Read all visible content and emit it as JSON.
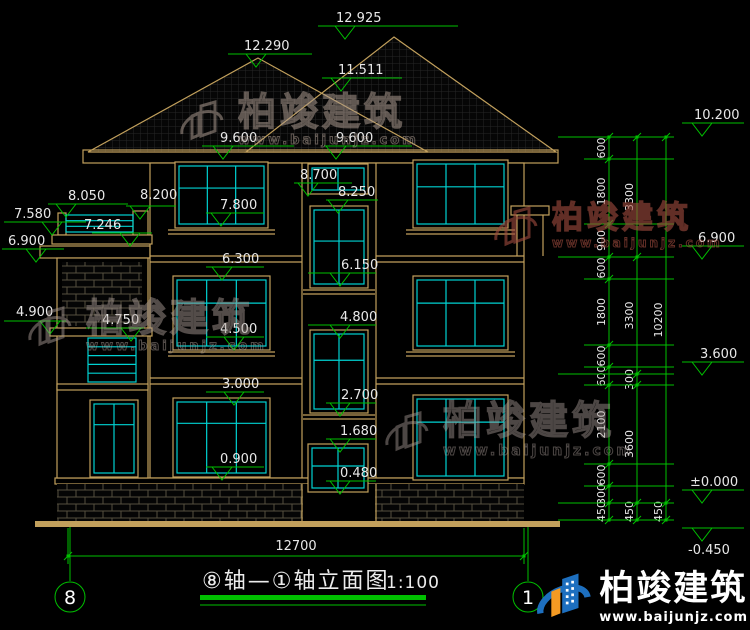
{
  "colors": {
    "green": "#00c000",
    "cyan": "#00d2d2",
    "tan": "#c2a05c",
    "text": "#e8e8e8",
    "brand_blue": "#1d6fbf",
    "brand_orange": "#f59a23"
  },
  "title": {
    "text": "⑧轴—①轴立面图",
    "scale": "1:100"
  },
  "axis_bubbles": [
    {
      "label": "8",
      "x": 70,
      "y": 597
    },
    {
      "label": "1",
      "x": 528,
      "y": 597
    }
  ],
  "bottom_dim": {
    "label": "12700",
    "y": 556,
    "x1": 68,
    "x2": 524,
    "tx": 296,
    "ty": 550
  },
  "elevation_markers": [
    {
      "t": "12.925",
      "tx": 336,
      "ty": 22,
      "y": 26,
      "x1": 318,
      "x2": 458,
      "ax": 345
    },
    {
      "t": "12.290",
      "tx": 244,
      "ty": 50,
      "y": 54,
      "x1": 228,
      "x2": 312,
      "ax": 256
    },
    {
      "t": "11.511",
      "tx": 338,
      "ty": 74,
      "y": 78,
      "x1": 322,
      "x2": 402,
      "ax": 341
    },
    {
      "t": "9.600",
      "tx": 220,
      "ty": 142,
      "y": 146,
      "x1": 202,
      "x2": 294,
      "ax": 223
    },
    {
      "t": "9.600",
      "tx": 336,
      "ty": 142,
      "y": 146,
      "x1": 324,
      "x2": 412,
      "ax": 336
    },
    {
      "t": "8.700",
      "tx": 300,
      "ty": 179,
      "y": 183,
      "x1": 294,
      "x2": 352,
      "ax": 308
    },
    {
      "t": "8.250",
      "tx": 338,
      "ty": 196,
      "y": 200,
      "x1": 326,
      "x2": 378,
      "ax": 338
    },
    {
      "t": "8.050",
      "tx": 68,
      "ty": 200,
      "y": 204,
      "x1": 48,
      "x2": 128,
      "ax": 66
    },
    {
      "t": "8.200",
      "tx": 140,
      "ty": 199,
      "y": 206,
      "x1": 126,
      "x2": 176,
      "ax": 140
    },
    {
      "t": "7.580",
      "tx": 14,
      "ty": 218,
      "y": 222,
      "x1": 4,
      "x2": 86,
      "ax": 52
    },
    {
      "t": "7.246",
      "tx": 84,
      "ty": 229,
      "y": 233,
      "x1": 92,
      "x2": 152,
      "ax": 130
    },
    {
      "t": "6.900",
      "tx": 8,
      "ty": 245,
      "y": 249,
      "x1": 2,
      "x2": 64,
      "ax": 36
    },
    {
      "t": "7.800",
      "tx": 220,
      "ty": 209,
      "y": 213,
      "x1": 206,
      "x2": 264,
      "ax": 221
    },
    {
      "t": "6.300",
      "tx": 222,
      "ty": 263,
      "y": 267,
      "x1": 206,
      "x2": 264,
      "ax": 222
    },
    {
      "t": "6.150",
      "tx": 341,
      "ty": 269,
      "y": 273,
      "x1": 308,
      "x2": 376,
      "ax": 340
    },
    {
      "t": "4.900",
      "tx": 16,
      "ty": 316,
      "y": 321,
      "x1": 4,
      "x2": 66,
      "ax": 50
    },
    {
      "t": "4.750",
      "tx": 102,
      "ty": 324,
      "y": 328,
      "x1": 86,
      "x2": 144,
      "ax": 131
    },
    {
      "t": "4.500",
      "tx": 220,
      "ty": 333,
      "y": 337,
      "x1": 206,
      "x2": 264,
      "ax": 234
    },
    {
      "t": "4.800",
      "tx": 340,
      "ty": 321,
      "y": 325,
      "x1": 308,
      "x2": 376,
      "ax": 340
    },
    {
      "t": "3.000",
      "tx": 222,
      "ty": 388,
      "y": 392,
      "x1": 206,
      "x2": 264,
      "ax": 234
    },
    {
      "t": "2.700",
      "tx": 341,
      "ty": 399,
      "y": 403,
      "x1": 326,
      "x2": 376,
      "ax": 340
    },
    {
      "t": "1.680",
      "tx": 340,
      "ty": 435,
      "y": 439,
      "x1": 326,
      "x2": 376,
      "ax": 340
    },
    {
      "t": "0.900",
      "tx": 220,
      "ty": 463,
      "y": 467,
      "x1": 206,
      "x2": 264,
      "ax": 222
    },
    {
      "t": "0.480",
      "tx": 340,
      "ty": 477,
      "y": 481,
      "x1": 326,
      "x2": 376,
      "ax": 340
    },
    {
      "t": "10.200",
      "tx": 694,
      "ty": 119,
      "y": 123,
      "x1": 682,
      "x2": 744,
      "ax": 702
    },
    {
      "t": "6.900",
      "tx": 698,
      "ty": 242,
      "y": 246,
      "x1": 682,
      "x2": 744,
      "ax": 702
    },
    {
      "t": "3.600",
      "tx": 700,
      "ty": 358,
      "y": 362,
      "x1": 682,
      "x2": 744,
      "ax": 702
    },
    {
      "t": "±0.000",
      "tx": 690,
      "ty": 486,
      "y": 490,
      "x1": 682,
      "x2": 744,
      "ax": 702
    },
    {
      "t": "-0.450",
      "tx": 688,
      "ty": 554,
      "y": 528,
      "x1": 682,
      "x2": 744,
      "ax": 702
    }
  ],
  "dim_chains": [
    {
      "x": 609,
      "ticks": [
        137,
        159,
        224,
        257,
        279,
        345,
        367,
        385,
        464,
        486,
        503,
        520
      ],
      "labels": [
        "600",
        "1800",
        "900",
        "600",
        "1800",
        "600",
        "600",
        "2100",
        "600",
        "300",
        "450"
      ]
    },
    {
      "x": 637,
      "ticks": [
        137,
        257,
        374,
        385,
        503,
        520
      ],
      "labels": [
        "3300",
        "3300",
        "300",
        "3600",
        "450"
      ]
    },
    {
      "x": 666,
      "ticks": [
        137,
        503,
        520
      ],
      "labels": [
        "10200",
        "450"
      ]
    }
  ],
  "ext_lines": [
    {
      "y": 137,
      "x1": 558
    },
    {
      "y": 159,
      "x1": 584
    },
    {
      "y": 224,
      "x1": 584
    },
    {
      "y": 257,
      "x1": 558
    },
    {
      "y": 279,
      "x1": 584
    },
    {
      "y": 345,
      "x1": 584
    },
    {
      "y": 367,
      "x1": 584
    },
    {
      "y": 374,
      "x1": 558
    },
    {
      "y": 385,
      "x1": 584
    },
    {
      "y": 464,
      "x1": 584
    },
    {
      "y": 486,
      "x1": 584
    },
    {
      "y": 503,
      "x1": 558
    },
    {
      "y": 520,
      "x1": 558
    }
  ],
  "windows": [
    {
      "x": 175,
      "y": 162,
      "w": 93,
      "h": 66,
      "c": 3,
      "s": 0.38
    },
    {
      "x": 413,
      "y": 160,
      "w": 95,
      "h": 68,
      "c": 3,
      "s": 0.38
    },
    {
      "x": 308,
      "y": 164,
      "w": 60,
      "h": 30,
      "c": 2,
      "s": 0
    },
    {
      "x": 310,
      "y": 206,
      "w": 58,
      "h": 82,
      "c": 2,
      "s": 0.42
    },
    {
      "x": 173,
      "y": 276,
      "w": 97,
      "h": 74,
      "c": 3,
      "s": 0.35
    },
    {
      "x": 413,
      "y": 276,
      "w": 95,
      "h": 74,
      "c": 3,
      "s": 0.35
    },
    {
      "x": 310,
      "y": 330,
      "w": 58,
      "h": 83,
      "c": 2,
      "s": 0.35
    },
    {
      "x": 173,
      "y": 398,
      "w": 97,
      "h": 79,
      "c": 3,
      "s": 0.3
    },
    {
      "x": 413,
      "y": 395,
      "w": 95,
      "h": 85,
      "c": 3,
      "s": 0.3
    },
    {
      "x": 308,
      "y": 444,
      "w": 60,
      "h": 48,
      "c": 2,
      "s": 0.45
    },
    {
      "x": 90,
      "y": 400,
      "w": 48,
      "h": 77,
      "c": 2,
      "s": 0.3
    }
  ],
  "railings": [
    {
      "x": 66,
      "y": 215,
      "w": 67,
      "h": 17,
      "bars": 2
    },
    {
      "x": 88,
      "y": 338,
      "w": 48,
      "h": 44,
      "bars": 4
    }
  ],
  "watermarks": [
    {
      "left": 178,
      "top": 92,
      "size": 38,
      "urlsize": 13,
      "color": "rgba(172,154,144,0.55)",
      "text": "柏竣建筑",
      "url": "www.baijunjz.com"
    },
    {
      "left": 492,
      "top": 198,
      "size": 31,
      "urlsize": 12,
      "color": "rgba(158,74,62,0.62)",
      "text": "柏竣建筑",
      "url": "www.baijunjz.com"
    },
    {
      "left": 26,
      "top": 298,
      "size": 38,
      "urlsize": 13,
      "color": "rgba(165,152,146,0.5)",
      "text": "柏竣建筑",
      "url": "www.baijunjz.com"
    },
    {
      "left": 383,
      "top": 402,
      "size": 39,
      "urlsize": 14,
      "color": "rgba(170,158,152,0.45)",
      "text": "柏竣建筑",
      "url": "www.baijunjz.com"
    }
  ],
  "brand": {
    "name": "柏竣建筑",
    "url": "www.baijunjz.com"
  }
}
